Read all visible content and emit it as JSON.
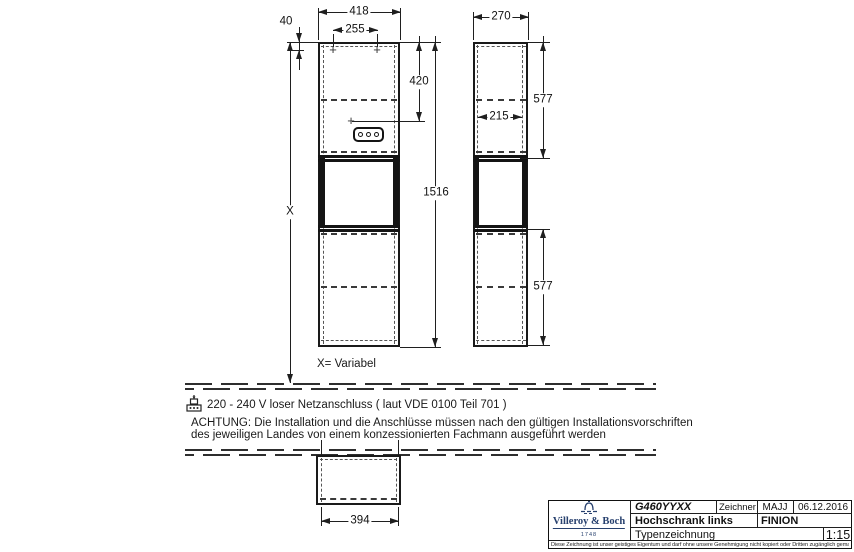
{
  "dims": {
    "front_width": "418",
    "front_inner_width": "255",
    "top_offset": "40",
    "socket_height": "420",
    "body_height": "1516",
    "height_variable": "X",
    "side_depth": "270",
    "side_inner_depth": "215",
    "section_upper": "577",
    "section_lower": "577",
    "bottom_width": "394"
  },
  "notes": {
    "variable": "X= Variabel",
    "power": "220 - 240 V loser Netzanschluss ( laut VDE 0100 Teil 701 )",
    "warning1": "ACHTUNG: Die Installation und die Anschlüsse müssen nach den gültigen Installationsvorschriften",
    "warning2": "des jeweiligen Landes von einem konzessionierten Fachmann ausgeführt werden"
  },
  "title_block": {
    "article_number": "G460YYXX",
    "drafter_label": "Zeichner",
    "drafter": "MAJJ",
    "date": "06.12.2016",
    "product": "Hochschrank links",
    "series": "FINION",
    "doc_type": "Typenzeichnung",
    "scale": "1:15",
    "brand": "Villeroy & Boch",
    "brand_year": "1748",
    "brand_color": "#27406e",
    "disclaimer": "Diese Zeichnung ist unser geistiges Eigentum und darf ohne unsere Genehmigung nicht kopiert oder Dritten zugänglich gemacht werden."
  }
}
